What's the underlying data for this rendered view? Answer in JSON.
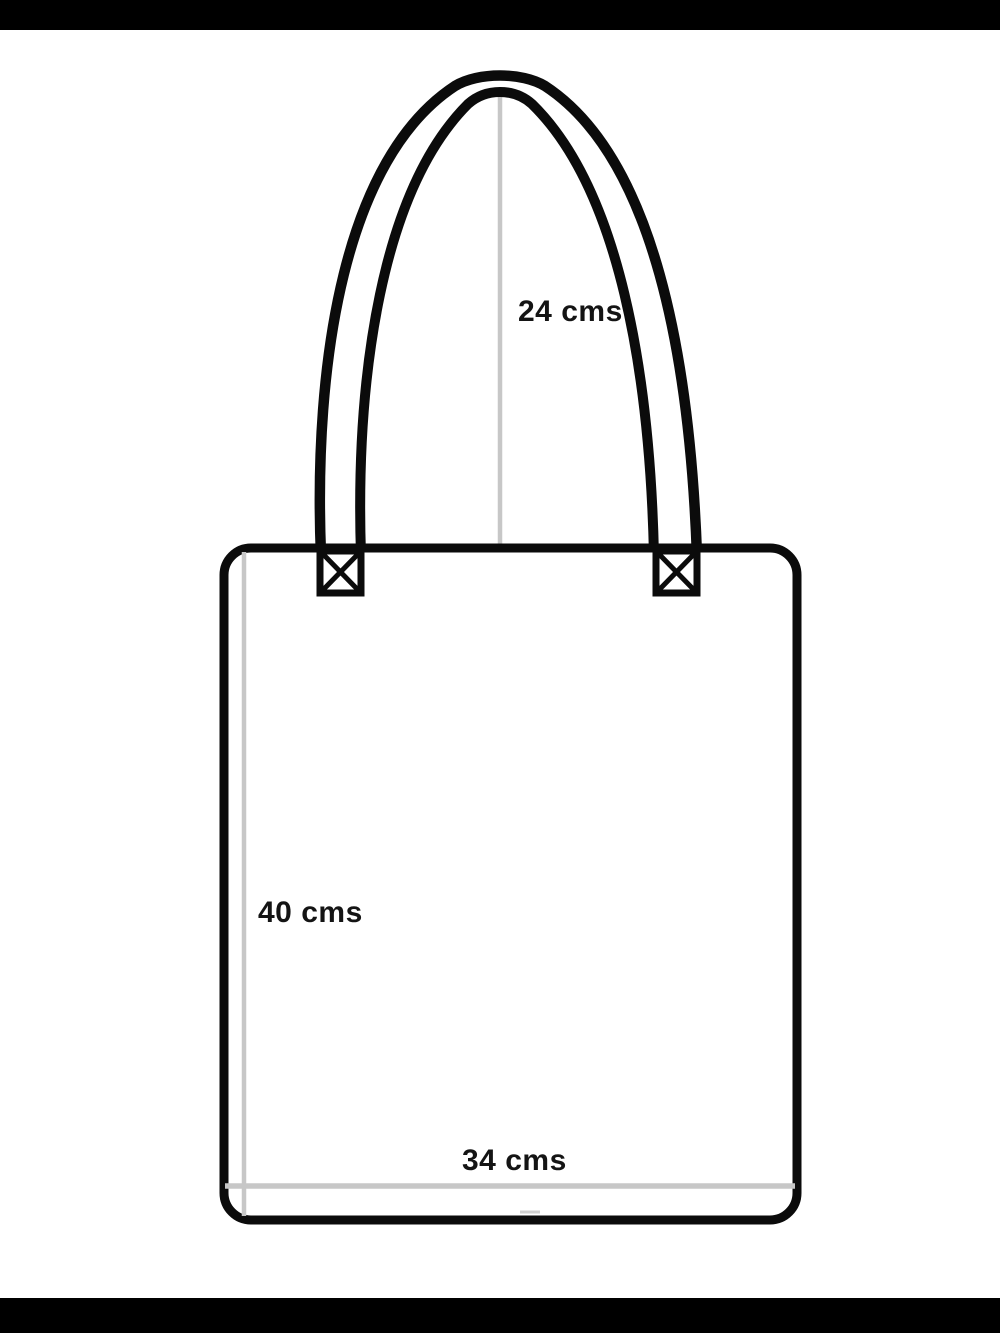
{
  "diagram": {
    "title": "tote-bag-dimension-diagram",
    "measurements": {
      "handle_drop": "24 cms",
      "bag_height": "40 cms",
      "bag_width": "34 cms"
    },
    "colors": {
      "outline": "#0b0b0b",
      "measure_line": "#c7c7c7",
      "measure_dash": "#cfcfcf",
      "label_text": "#141414",
      "letterbox": "#000000",
      "background": "#ffffff"
    }
  }
}
